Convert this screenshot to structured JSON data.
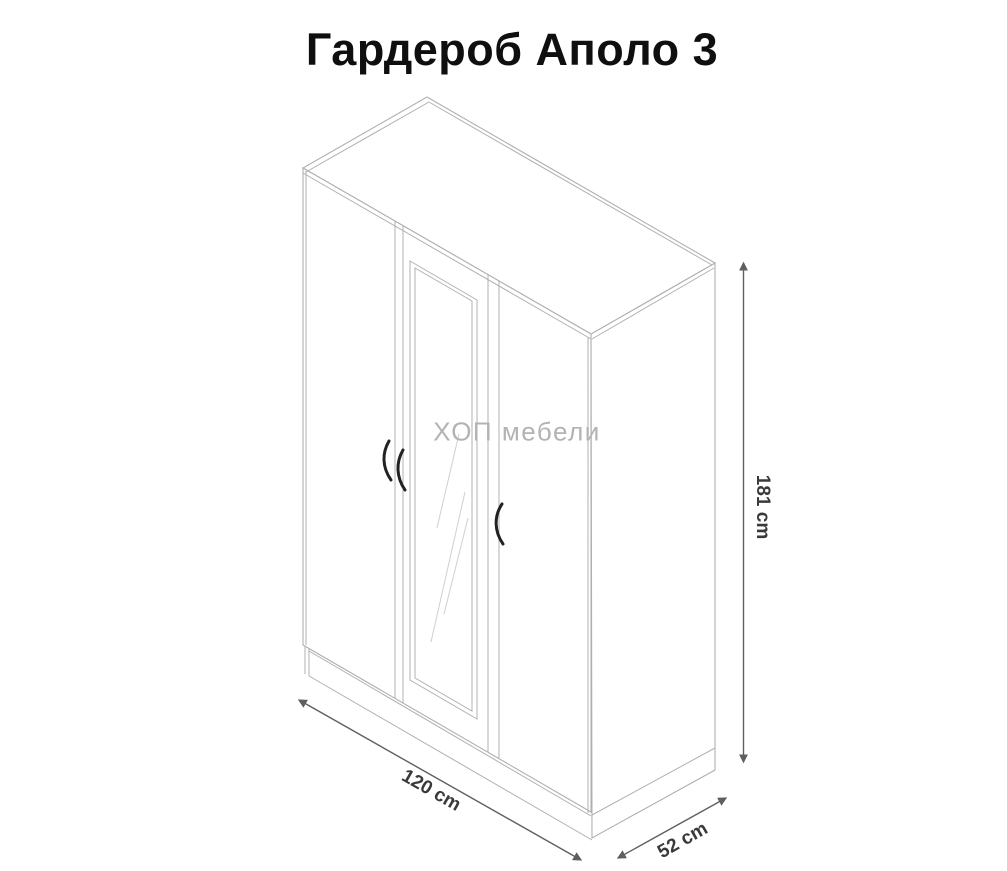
{
  "page": {
    "title": "Гардероб Аполо 3",
    "watermark": "ХОП мебели"
  },
  "dimensions": {
    "height": {
      "value": 181,
      "unit": "cm",
      "label": "181 cm"
    },
    "width": {
      "value": 120,
      "unit": "cm",
      "label": "120 cm"
    },
    "depth": {
      "value": 52,
      "unit": "cm",
      "label": "52 cm"
    }
  },
  "diagram": {
    "subject": "wardrobe line drawing",
    "doors": 3,
    "mirror_door": "center"
  },
  "colors": {
    "background": "#ffffff",
    "title_text": "#0f0f0f",
    "drawing_line": "#b0b0b0",
    "dimension_line": "#5f5f5f",
    "dimension_text": "#3a3a3a",
    "watermark_text": "#b3b3b3",
    "handle": "#222222"
  }
}
